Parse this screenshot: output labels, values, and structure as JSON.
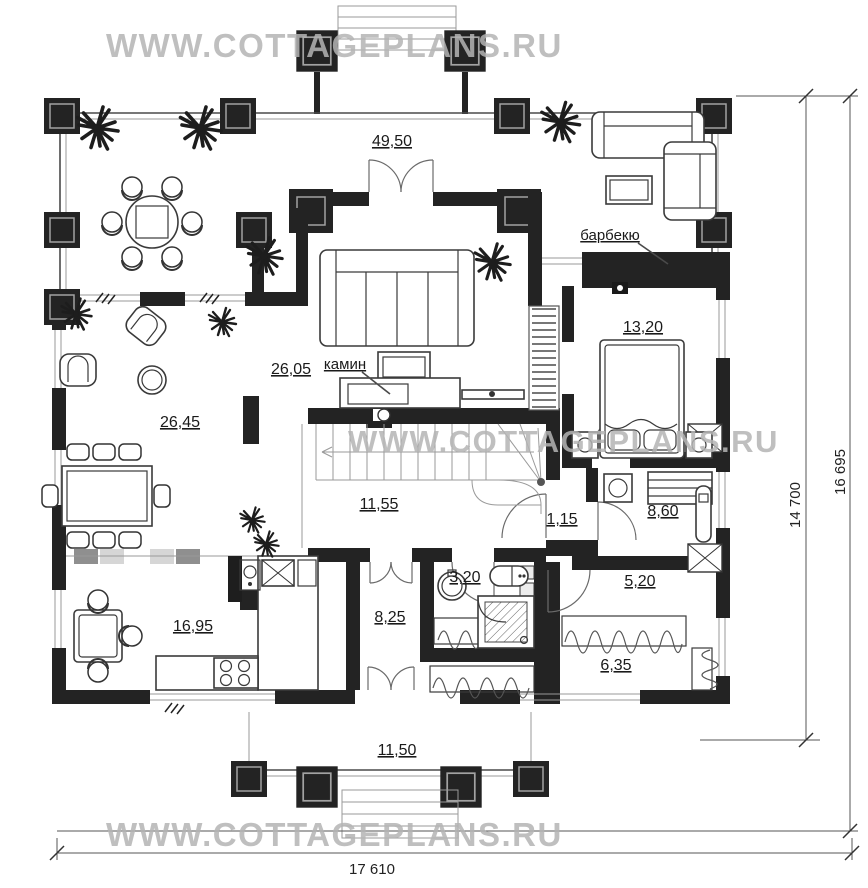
{
  "watermark": {
    "text": "WWW.COTTAGEPLANS.RU"
  },
  "labels": {
    "terrace": "49,50",
    "living": "26,05",
    "dining": "26,45",
    "bedroom": "13,20",
    "hall": "11,55",
    "corridor": "1,15",
    "bathroom_big": "8,60",
    "bathroom_small": "3,20",
    "pantry": "5,20",
    "entry": "8,25",
    "kitchen": "16,95",
    "boiler": "6,35",
    "porch": "11,50"
  },
  "annotations": {
    "fireplace": "камин",
    "barbecue": "барбекю"
  },
  "dimensions": {
    "depth_main": "14 700",
    "depth_full": "16 695",
    "width_full": "17 610"
  },
  "colors": {
    "wall": "#232323",
    "watermark": "#b4b4b4",
    "background": "#ffffff",
    "line": "#4a4a4a"
  }
}
